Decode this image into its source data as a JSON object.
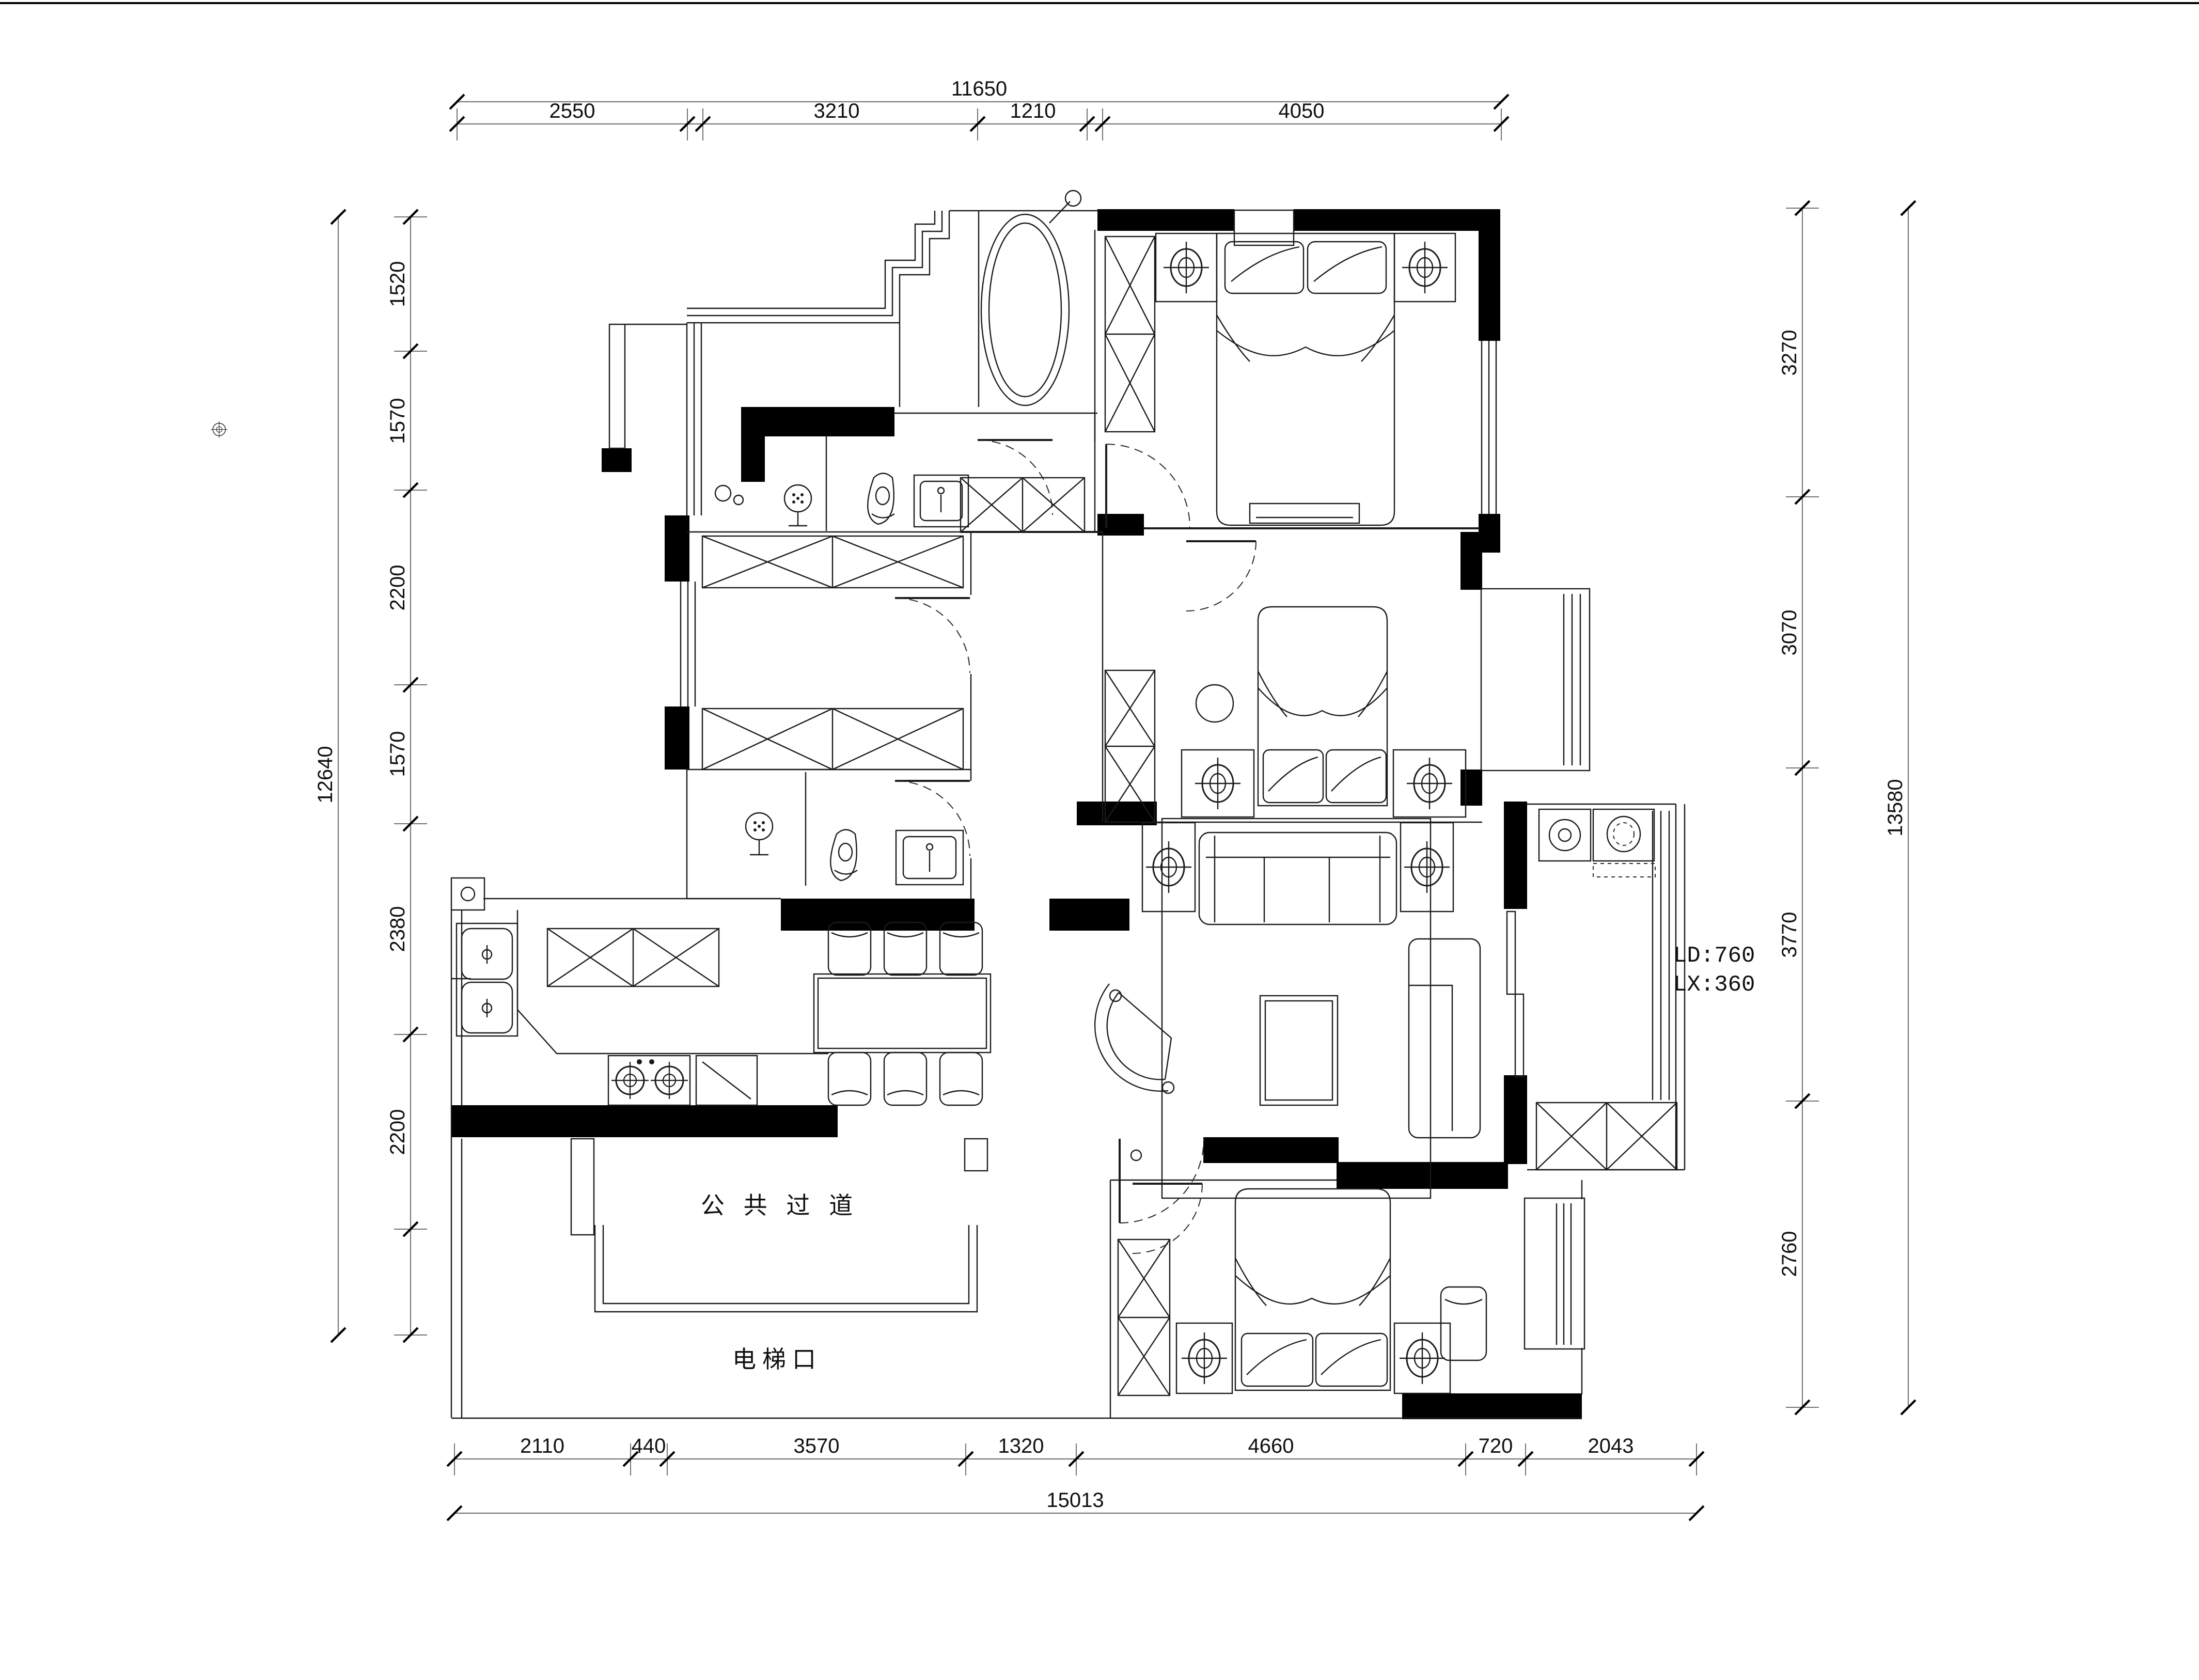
{
  "dims": {
    "top": {
      "total": "11650",
      "segments": [
        "2550",
        "3210",
        "1210",
        "4050"
      ]
    },
    "left": {
      "total": "12640",
      "segments": [
        "1520",
        "1570",
        "2200",
        "1570",
        "2380",
        "2200"
      ]
    },
    "right": {
      "total": "13580",
      "segments": [
        "3270",
        "3070",
        "3770",
        "2760"
      ]
    },
    "bottom": {
      "total": "15013",
      "segments": [
        "2110",
        "440",
        "3570",
        "1320",
        "4660",
        "720",
        "2043"
      ]
    }
  },
  "labels": {
    "corridor": "公 共 过 道",
    "elevator": "电梯口",
    "ld": "LD:760",
    "lx": "LX:360"
  }
}
